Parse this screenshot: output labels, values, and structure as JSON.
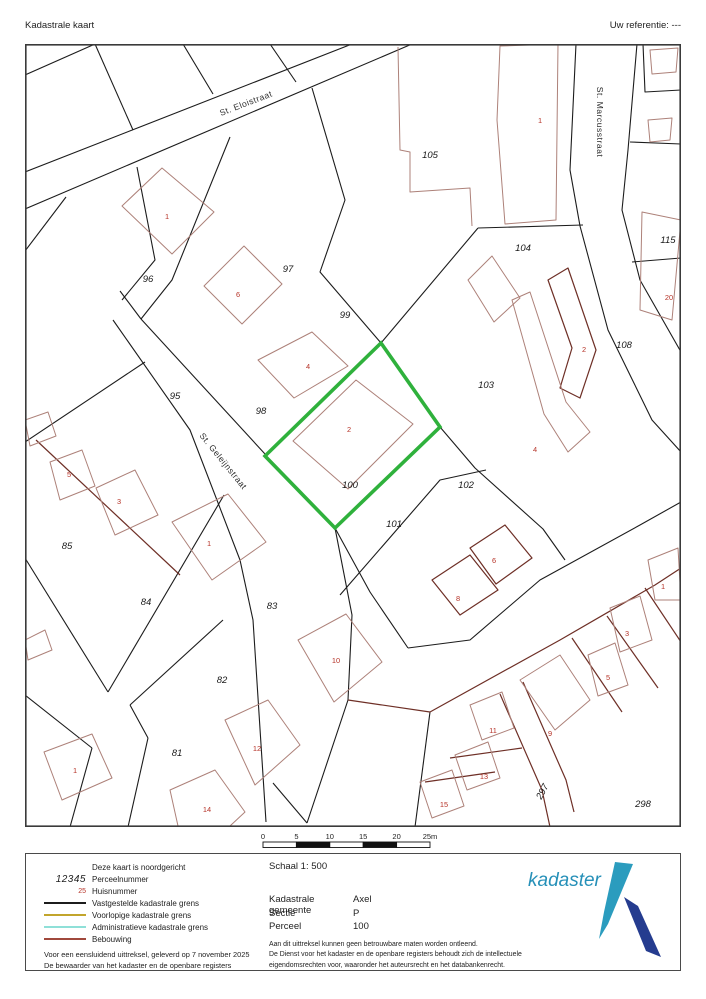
{
  "header": {
    "left": "Kadastrale kaart",
    "right": "Uw referentie: ---"
  },
  "map": {
    "colors": {
      "boundary": "#1c1c1c",
      "building_light": "#ad8179",
      "building_dark": "#6e2f26",
      "highlight_green": "#2fb13c",
      "house_number_red": "#b63328"
    },
    "highlight_parcel": "100",
    "streets": [
      {
        "name": "St. Eloistraat",
        "x": 247,
        "y": 106,
        "rot": -21
      },
      {
        "name": "St. Marcusstraat",
        "x": 597,
        "y": 122,
        "rot": 90
      },
      {
        "name": "St. Geleijnstraat",
        "x": 221,
        "y": 463,
        "rot": 51
      }
    ],
    "parcel_labels": [
      {
        "n": "96",
        "x": 148,
        "y": 282
      },
      {
        "n": "97",
        "x": 288,
        "y": 272
      },
      {
        "n": "99",
        "x": 345,
        "y": 318
      },
      {
        "n": "105",
        "x": 430,
        "y": 158
      },
      {
        "n": "104",
        "x": 523,
        "y": 251
      },
      {
        "n": "115",
        "x": 668,
        "y": 243
      },
      {
        "n": "108",
        "x": 624,
        "y": 348
      },
      {
        "n": "103",
        "x": 486,
        "y": 388
      },
      {
        "n": "95",
        "x": 175,
        "y": 399
      },
      {
        "n": "98",
        "x": 261,
        "y": 414
      },
      {
        "n": "100",
        "x": 350,
        "y": 488,
        "fs": 10.5
      },
      {
        "n": "102",
        "x": 466,
        "y": 488
      },
      {
        "n": "101",
        "x": 394,
        "y": 527
      },
      {
        "n": "85",
        "x": 67,
        "y": 549
      },
      {
        "n": "84",
        "x": 146,
        "y": 605
      },
      {
        "n": "83",
        "x": 272,
        "y": 609
      },
      {
        "n": "82",
        "x": 222,
        "y": 683
      },
      {
        "n": "81",
        "x": 177,
        "y": 756
      },
      {
        "n": "297",
        "x": 545,
        "y": 793,
        "rot": -62
      },
      {
        "n": "298",
        "x": 643,
        "y": 807
      }
    ],
    "house_numbers": [
      {
        "n": "1",
        "x": 167,
        "y": 219
      },
      {
        "n": "6",
        "x": 238,
        "y": 297
      },
      {
        "n": "4",
        "x": 308,
        "y": 369
      },
      {
        "n": "2",
        "x": 349,
        "y": 432
      },
      {
        "n": "1",
        "x": 540,
        "y": 123
      },
      {
        "n": "2",
        "x": 584,
        "y": 352
      },
      {
        "n": "20",
        "x": 669,
        "y": 300
      },
      {
        "n": "4",
        "x": 535,
        "y": 452
      },
      {
        "n": "5",
        "x": 69,
        "y": 477
      },
      {
        "n": "3",
        "x": 119,
        "y": 504
      },
      {
        "n": "1",
        "x": 209,
        "y": 546
      },
      {
        "n": "6",
        "x": 494,
        "y": 563
      },
      {
        "n": "8",
        "x": 458,
        "y": 601
      },
      {
        "n": "10",
        "x": 336,
        "y": 663
      },
      {
        "n": "12",
        "x": 257,
        "y": 751
      },
      {
        "n": "14",
        "x": 207,
        "y": 812
      },
      {
        "n": "1",
        "x": 75,
        "y": 773
      },
      {
        "n": "1",
        "x": 663,
        "y": 589
      },
      {
        "n": "3",
        "x": 627,
        "y": 636
      },
      {
        "n": "5",
        "x": 608,
        "y": 680
      },
      {
        "n": "11",
        "x": 493,
        "y": 733
      },
      {
        "n": "9",
        "x": 550,
        "y": 736
      },
      {
        "n": "13",
        "x": 484,
        "y": 779
      },
      {
        "n": "15",
        "x": 444,
        "y": 807
      }
    ]
  },
  "scalebar": {
    "labels": [
      "0",
      "5",
      "10",
      "15",
      "20",
      "25m"
    ]
  },
  "legend": {
    "items": [
      {
        "sample": "none",
        "label": "Deze kaart is noordgericht"
      },
      {
        "sample": "perceel",
        "sample_text": "12345",
        "label": "Perceelnummer"
      },
      {
        "sample": "huis",
        "sample_text": "25",
        "label": "Huisnummer"
      },
      {
        "sample": "line",
        "color": "#1c1c1c",
        "label": "Vastgestelde kadastrale grens"
      },
      {
        "sample": "line",
        "color": "#c2a52c",
        "label": "Voorlopige kadastrale grens"
      },
      {
        "sample": "line",
        "color": "#8fe0d8",
        "label": "Administratieve kadastrale grens"
      },
      {
        "sample": "line",
        "color": "#a0483c",
        "label": "Bebouwing"
      }
    ]
  },
  "footer_left": [
    "Voor een eensluidend uittreksel, geleverd op 7 november 2025",
    "De bewaarder van het kadaster en de openbare registers"
  ],
  "info": {
    "schaal": "Schaal 1: 500",
    "rows": [
      {
        "label": "Kadastrale gemeente",
        "value": "Axel"
      },
      {
        "label": "Sectie",
        "value": "P"
      },
      {
        "label": "Perceel",
        "value": "100"
      }
    ],
    "disclaimer": [
      "Aan dit uittreksel kunnen geen betrouwbare maten worden ontleend.",
      "De Dienst voor het kadaster en de openbare registers behoudt zich de intellectuele",
      "eigendomsrechten voor, waaronder het auteursrecht en het databankenrecht."
    ]
  },
  "logo": {
    "text": "kadaster",
    "teal": "#2b9cbe",
    "navy": "#253c8f",
    "text_color": "#2690b8"
  }
}
